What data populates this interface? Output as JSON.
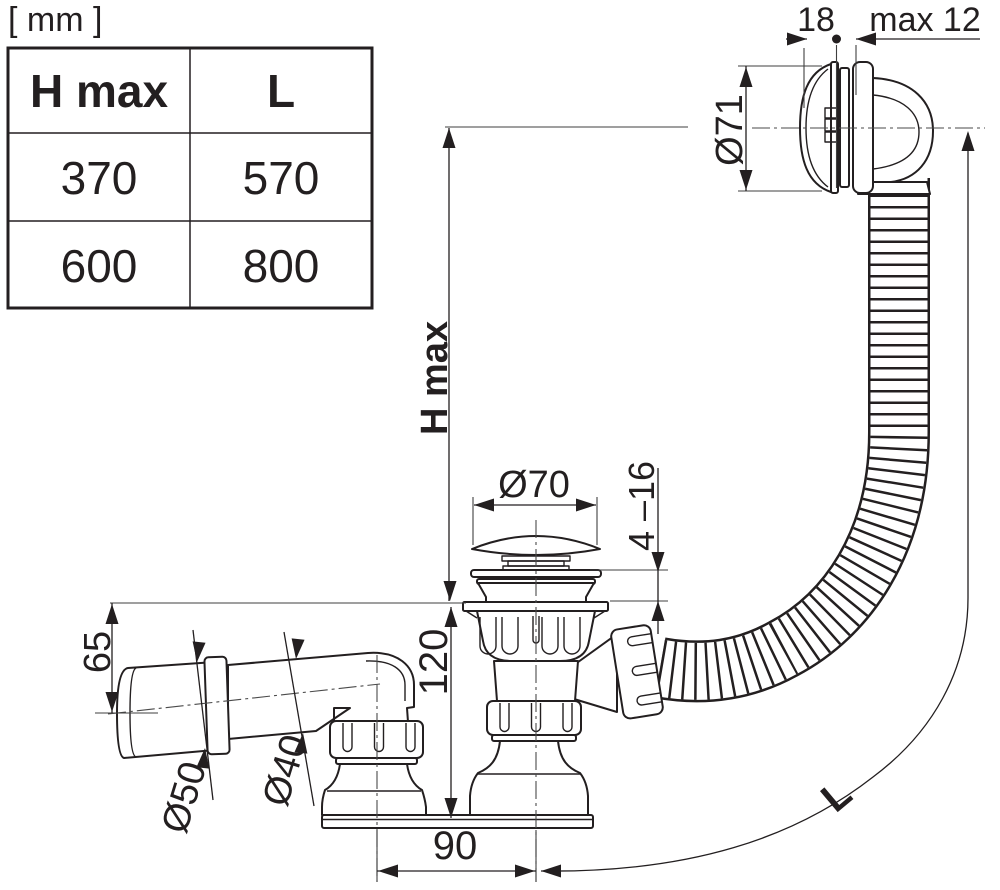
{
  "unit_label": "[ mm ]",
  "table": {
    "headers": [
      "H max",
      "L"
    ],
    "rows": [
      [
        "370",
        "570"
      ],
      [
        "600",
        "800"
      ]
    ]
  },
  "dimensions": {
    "height_max": "H max",
    "hose_length": "L",
    "overflow_diameter": "Ø71",
    "overflow_depth": "18",
    "wall_max": "max 12",
    "plug_diameter": "Ø70",
    "rim_thickness": "4 –16",
    "body_height": "120",
    "outlet_drop": "65",
    "outlet_offset": "90",
    "outlet_pipe_diameter": "Ø50",
    "outlet_stub_diameter": "Ø40"
  },
  "colors": {
    "line": "#231f20",
    "thin_line": "#3f3f3f",
    "background": "#ffffff"
  }
}
